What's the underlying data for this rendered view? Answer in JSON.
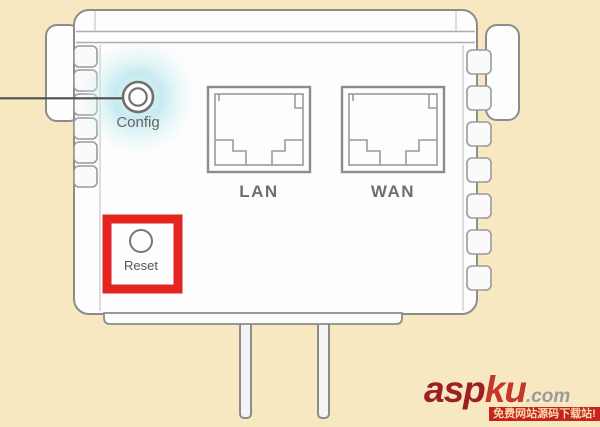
{
  "device": {
    "name": "wall-plug wifi extender rear view",
    "config_label": "Config",
    "lan_label": "LAN",
    "wan_label": "WAN",
    "reset_label": "Reset"
  },
  "watermark": {
    "brand_part1": "asp",
    "brand_part2": "ku",
    "brand_suffix": ".com",
    "banner_text": "免费网站源码下载站!"
  },
  "colors": {
    "background": "#F8E8C1",
    "device_fill": "#FDFDFD",
    "outline_gray": "#8C8C8C",
    "label_gray": "#6E6E6E",
    "highlight_red": "#E32420",
    "glow_cyan": "#BDE7EE",
    "brand_dark_red": "#9C2023",
    "brand_red": "#C5362B",
    "brand_suffix_gray": "#9B9B9B",
    "banner_red": "#C7231E",
    "banner_text_color": "#F7DBA8"
  }
}
